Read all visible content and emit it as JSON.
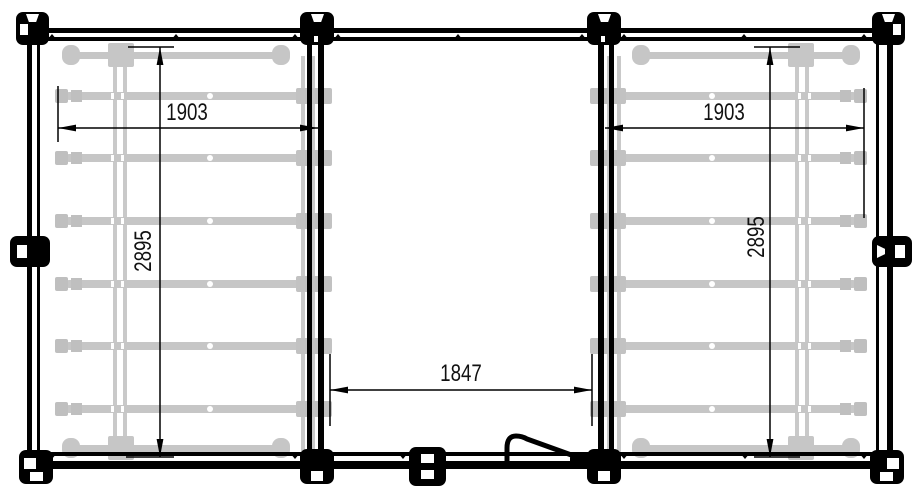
{
  "drawing": {
    "background": "#ffffff",
    "line_color": "#000000",
    "reference_color": "#c6c6c6",
    "labels": {
      "bay_left_width": "1903",
      "bay_right_width": "1903",
      "bay_left_depth": "2895",
      "bay_right_depth": "2895",
      "center_opening_width": "1847"
    },
    "structure": {
      "bays": 2,
      "rails_per_bay": 6,
      "crossbars_per_bay": 2,
      "vertical_rails_per_bay": 2
    }
  }
}
